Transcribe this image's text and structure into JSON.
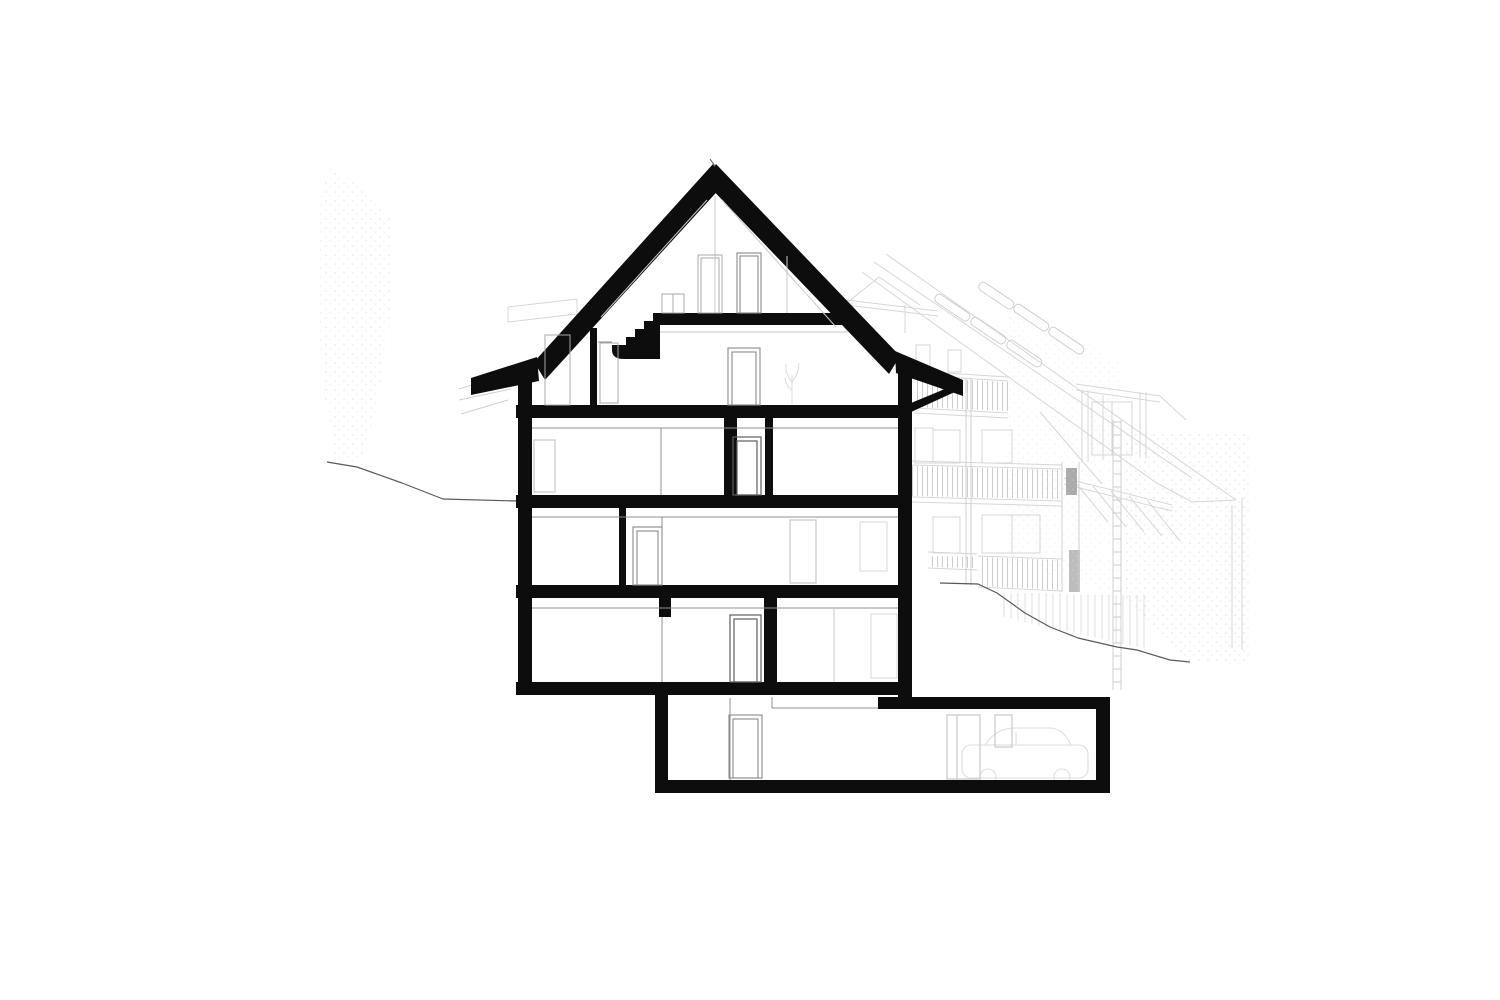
{
  "drawing": {
    "kind": "architectural-building-cross-section",
    "orientation": "section through gabled house on sloped site, basement garage extending right",
    "floors": [
      {
        "id": "attic",
        "desc": "attic under gable roof with stair arriving from below"
      },
      {
        "id": "upper-floor",
        "desc": "floor directly under attic slab"
      },
      {
        "id": "second-floor",
        "desc": "floor with central corridor between two cut walls"
      },
      {
        "id": "first-floor",
        "desc": "floor with single interior cut wall and door"
      },
      {
        "id": "ground-floor",
        "desc": "lowest full-width floor with hanging wall stub"
      },
      {
        "id": "basement-garage",
        "desc": "basement stepping down and extending right, garage with parked car sketch"
      }
    ],
    "features": [
      "gable roof with flared eaves and right eave strut",
      "interior stair with quarter-turn landing to attic",
      "door and window frames drawn in elevation beyond the cut",
      "faint background elevation with three balcony railing bands",
      "background roof plane with skylight slots and ridge dormer",
      "pergola canopy with rafters",
      "terrain line falling to the right",
      "tree sketch at far left",
      "car silhouette parked in garage"
    ],
    "counts": {
      "roof_skylight_slots": 6,
      "balcony_bands": 3,
      "section_doors": 7,
      "canopy_rafters": 5
    },
    "colors": {
      "paper": "#ffffff",
      "section-cut": "#0d0d0d",
      "line-strong": "#555555",
      "line-mid": "#909090",
      "line-light": "#c9c9c9",
      "line-faint": "#dcdcdc",
      "bg-elevation": "#d7d7d7",
      "terrain": "#5a5a5a"
    }
  }
}
